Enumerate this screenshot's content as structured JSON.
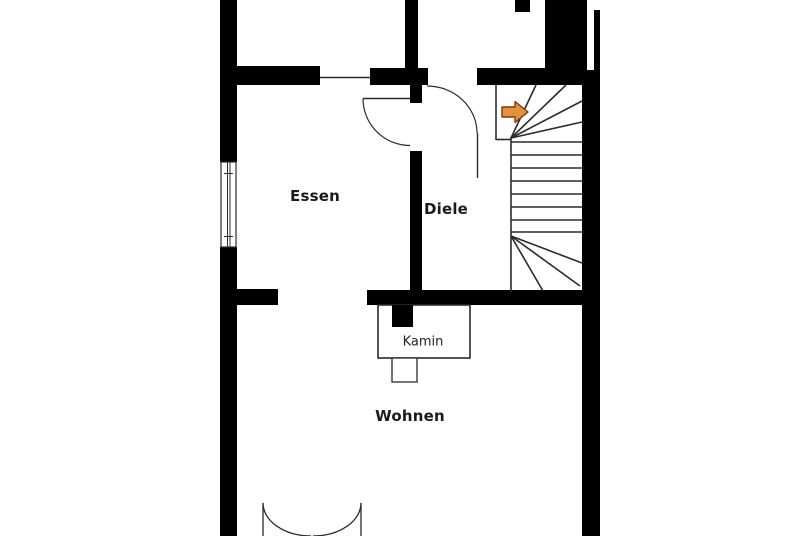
{
  "floorplan": {
    "background_color": "#ffffff",
    "wall_color": "#000000",
    "outline_color": "#2b2b2b",
    "rooms": [
      {
        "name": "essen",
        "label": "Essen"
      },
      {
        "name": "diele",
        "label": "Diele"
      },
      {
        "name": "wohnen",
        "label": "Wohnen"
      }
    ],
    "fixtures": [
      {
        "name": "kamin",
        "label": "Kamin"
      }
    ],
    "symbols": {
      "stair_direction_arrow": {
        "direction": "right",
        "color": "#e0923f",
        "border_color": "#7a3a0e"
      },
      "window": "double-line-window-left-wall",
      "doors": [
        "single-swing-door-essen",
        "single-swing-door-diele",
        "double-swing-door-wohnen"
      ],
      "staircase": "winder-staircase-up"
    }
  }
}
